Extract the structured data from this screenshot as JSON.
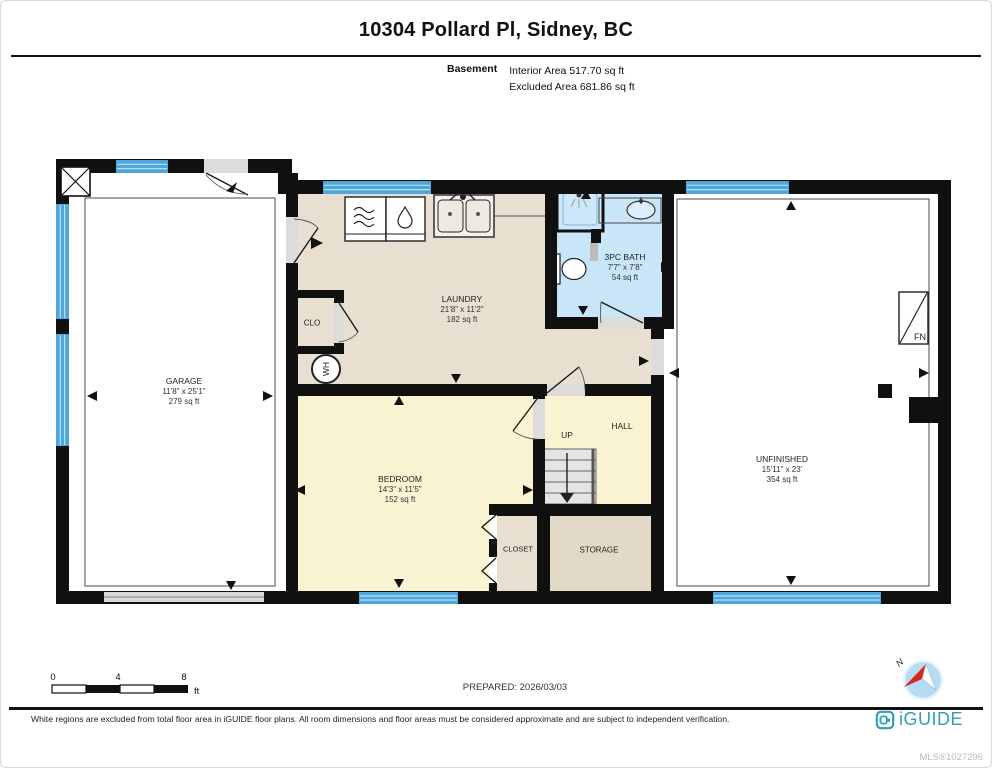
{
  "header": {
    "title": "10304 Pollard Pl, Sidney, BC",
    "floor_label": "Basement",
    "interior_area": "Interior Area 517.70 sq ft",
    "excluded_area": "Excluded Area 681.86 sq ft"
  },
  "rooms": {
    "garage": {
      "name": "GARAGE",
      "dims": "11'8\" x 25'1\"",
      "area": "279 sq ft"
    },
    "laundry": {
      "name": "LAUNDRY",
      "dims": "21'8\" x 11'2\"",
      "area": "182 sq ft"
    },
    "bath": {
      "name": "3PC BATH",
      "dims": "7'7\" x 7'8\"",
      "area": "54 sq ft"
    },
    "bedroom": {
      "name": "BEDROOM",
      "dims": "14'3\" x 11'5\"",
      "area": "152 sq ft"
    },
    "unfinished": {
      "name": "UNFINISHED",
      "dims": "15'11\" x 23'",
      "area": "354 sq ft"
    },
    "hall": {
      "name": "HALL"
    },
    "storage": {
      "name": "STORAGE"
    },
    "closet": {
      "name": "CLOSET"
    },
    "clo": {
      "name": "CLO"
    }
  },
  "labels": {
    "up": "UP",
    "water_heater": "WH",
    "furnace": "FN"
  },
  "scale_bar": {
    "ticks": [
      "0",
      "4",
      "8"
    ],
    "unit": "ft"
  },
  "prepared": "PREPARED: 2026/03/03",
  "compass": {
    "north": "N"
  },
  "footer": {
    "disclaimer": "White regions are excluded from total floor area in iGUIDE floor plans. All room dimensions and floor areas must be considered approximate and are subject to independent verification.",
    "brand": "iGUIDE",
    "mls": "MLS®1027296"
  },
  "colors": {
    "wall": "#101010",
    "beige": "#e8dfd0",
    "yellow": "#faf3d2",
    "bath_blue": "#c8e6f8",
    "shower_blue": "#cde9f9",
    "storage_tan": "#e2d9c7",
    "window_blue": "#4da7dc",
    "door_gray": "#dcdcdc",
    "garage_door_gray": "#d9d9d9",
    "stairs_gray": "#e4e4e4",
    "brand_teal": "#2f9fba",
    "mls_gray": "#b9b9b9",
    "compass_blue": "#b5dcf2",
    "compass_red": "#d9251d"
  }
}
